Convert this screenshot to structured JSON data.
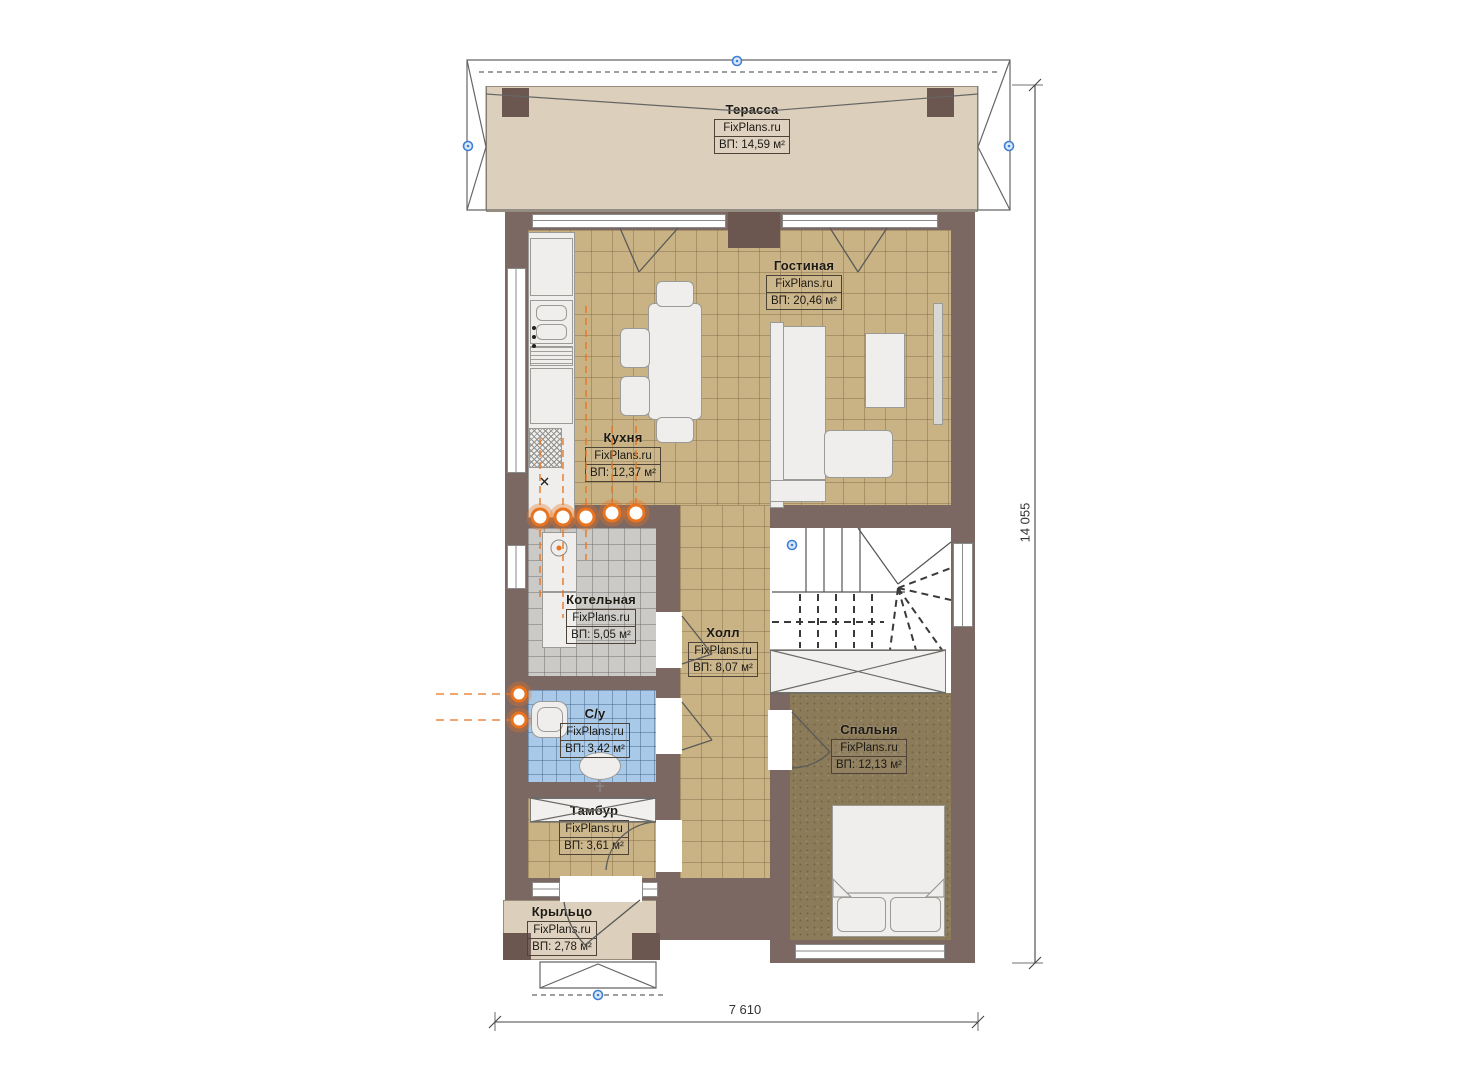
{
  "plan_title": "First floor plan",
  "site_watermark": "FixPlans.ru",
  "rooms": [
    {
      "id": "terrace",
      "name": "Терасса",
      "watermark": "FixPlans.ru",
      "area": "ВП: 14,59 м²"
    },
    {
      "id": "living",
      "name": "Гостиная",
      "watermark": "FixPlans.ru",
      "area": "ВП: 20,46 м²"
    },
    {
      "id": "kitchen",
      "name": "Кухня",
      "watermark": "FixPlans.ru",
      "area": "ВП: 12,37 м²"
    },
    {
      "id": "boiler",
      "name": "Котельная",
      "watermark": "FixPlans.ru",
      "area": "ВП: 5,05 м²"
    },
    {
      "id": "hall",
      "name": "Холл",
      "watermark": "FixPlans.ru",
      "area": "ВП: 8,07 м²"
    },
    {
      "id": "bathroom",
      "name": "С/у",
      "watermark": "FixPlans.ru",
      "area": "ВП: 3,42 м²"
    },
    {
      "id": "bedroom",
      "name": "Спальня",
      "watermark": "FixPlans.ru",
      "area": "ВП: 12,13 м²"
    },
    {
      "id": "vestibule",
      "name": "Тамбур",
      "watermark": "FixPlans.ru",
      "area": "ВП: 3,61 м²"
    },
    {
      "id": "porch",
      "name": "Крыльцо",
      "watermark": "FixPlans.ru",
      "area": "ВП: 2,78 м²"
    }
  ],
  "dimensions": {
    "height": "14 055",
    "width": "7 610"
  },
  "colors": {
    "wall": "#7b6863",
    "wall_pier": "#6b5750",
    "tile_tan": "#c9b284",
    "terrace_beige": "#dccfbb",
    "boiler_gray": "#cccac6",
    "bathroom_blue": "#a9c9e8",
    "bedroom_carpet": "#8c7b59",
    "heating_orange": "#e87420",
    "marker_blue": "#3f7fd4",
    "linework": "#555555"
  },
  "icons": {
    "level_marker": "blue circle marker",
    "heating_manifold": "orange circle valve",
    "stairs_up": "winder staircase"
  }
}
